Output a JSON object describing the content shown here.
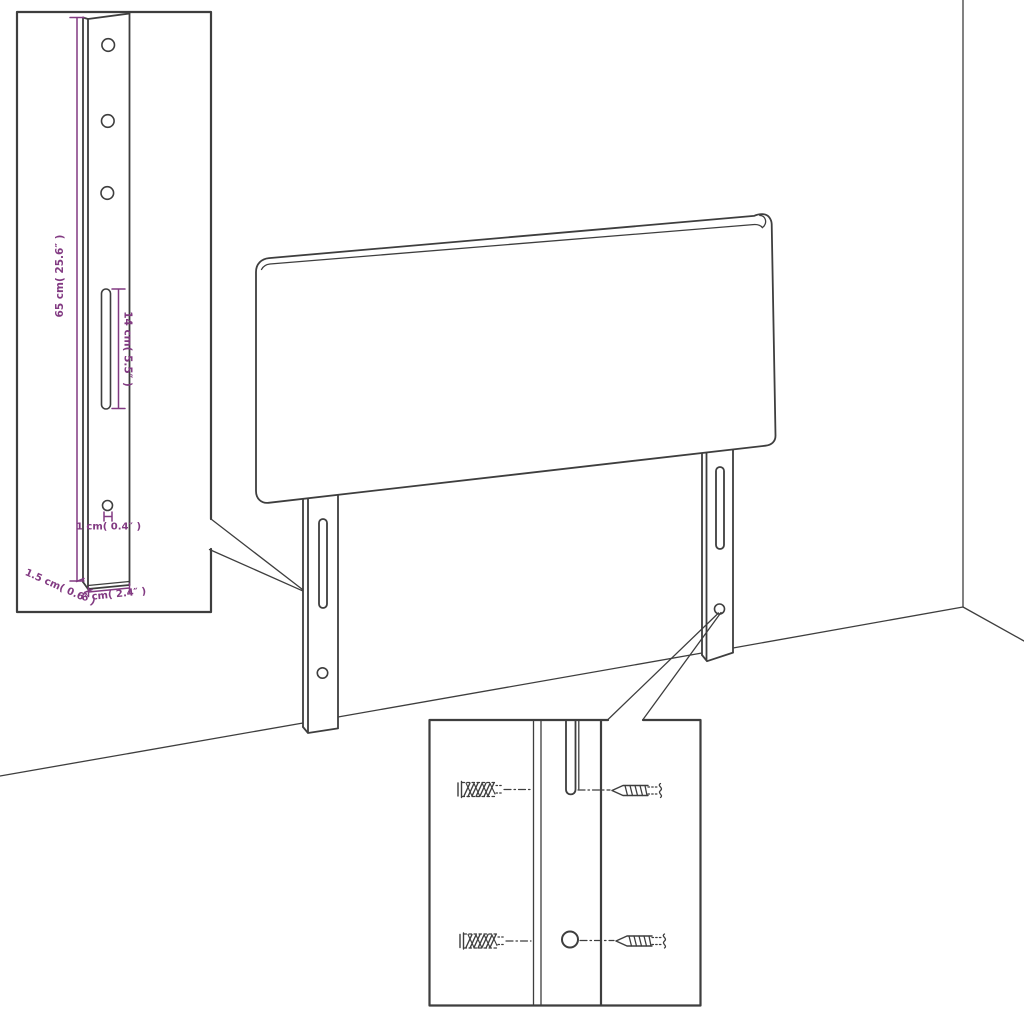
{
  "labels": {
    "height": "65 cm( 25.6″ )",
    "slot_length": "14 cm( 5.5″ )",
    "hole_diameter": "1 cm( 0.4″ )",
    "side_thickness": "1.5 cm( 0.6″ )",
    "leg_width": "6 cm( 2.4″ )"
  },
  "colors": {
    "background": "#FFFFFF",
    "line": "#3E3E3E",
    "dimension": "#823A82"
  },
  "scene": {
    "subject": "headboard with two mounting legs against room corner",
    "insets": [
      "bracket-dimension-detail",
      "wall-anchor-and-screw-mounting-detail"
    ],
    "bracket_detail": {
      "top_holes": 3,
      "bottom_holes": 1,
      "slots": 1
    },
    "headboard": {
      "legs": 2,
      "slots_per_leg": 1,
      "holes_per_leg": 1
    },
    "mounting_detail": {
      "rows": 2,
      "fasteners_per_row": [
        "wall-anchor",
        "screw"
      ]
    }
  }
}
